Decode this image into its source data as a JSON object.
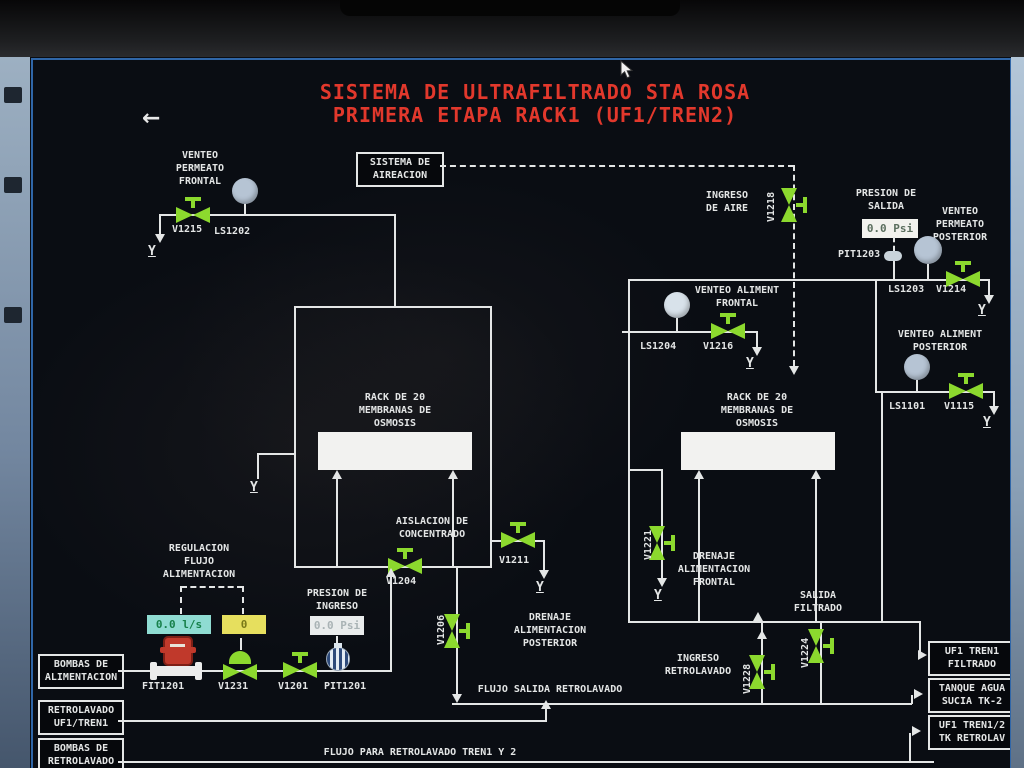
{
  "colors": {
    "bg": "#0a0d13",
    "line": "#e4e6e6",
    "valve": "#8cd92e",
    "title": "#e2382c",
    "cyan_box": "#8fdcd2",
    "yellow_box": "#e6df5e",
    "circle": "#b6c4d4",
    "circle_light": "#d8e2ea",
    "red_instrument": "#c0392b",
    "blue_instrument": "#2e4a7a"
  },
  "icons": {
    "back": "←"
  },
  "title": {
    "line1": "SISTEMA DE ULTRAFILTRADO STA ROSA",
    "line2": "PRIMERA ETAPA RACK1 (UF1/TREN2)"
  },
  "labels": {
    "venteo_permeato_frontal": "VENTEO\nPERMEATO\nFRONTAL",
    "sistema_aireacion": "SISTEMA DE\nAIREACION",
    "ingreso_de_aire": "INGRESO\nDE AIRE",
    "presion_de_salida": "PRESION DE\nSALIDA",
    "venteo_permeato_posterior": "VENTEO\nPERMEATO\nPOSTERIOR",
    "venteo_aliment_frontal": "VENTEO ALIMENT\nFRONTAL",
    "venteo_aliment_posterior": "VENTEO ALIMENT\nPOSTERIOR",
    "rack_membranas": "RACK DE 20\nMEMBRANAS DE\nOSMOSIS",
    "aislacion_concentrado": "AISLACION DE\nCONCENTRADO",
    "drenaje_alimentacion_frontal": "DRENAJE\nALIMENTACION\nFRONTAL",
    "drenaje_alimentacion_posterior": "DRENAJE\nALIMENTACION\nPOSTERIOR",
    "salida_filtrado": "SALIDA\nFILTRADO",
    "regulacion_flujo": "REGULACION\nFLUJO\nALIMENTACION",
    "presion_de_ingreso": "PRESION DE\nINGRESO",
    "ingreso_retrolavado": "INGRESO\nRETROLAVADO",
    "flujo_salida_retrolavado": "FLUJO SALIDA RETROLAVADO",
    "flujo_para_retrolavado": "FLUJO PARA RETROLAVADO TREN1 Y 2",
    "bombas_alimentacion": "BOMBAS DE\nALIMENTACION",
    "retrolavado_uf1_tren1": "RETROLAVADO\nUF1/TREN1",
    "bombas_retrolavado": "BOMBAS DE\nRETROLAVADO",
    "uf1_tren1_filtrado": "UF1 TREN1\nFILTRADO",
    "tanque_agua_sucia": "TANQUE AGUA\nSUCIA TK-2",
    "uf1_tren12_retrolav": "UF1 TREN1/2\nTK RETROLAV"
  },
  "tags": {
    "v1215": "V1215",
    "ls1202": "LS1202",
    "v1218": "V1218",
    "pit1203": "PIT1203",
    "ls1203": "LS1203",
    "v1214": "V1214",
    "ls1204": "LS1204",
    "v1216": "V1216",
    "ls1101": "LS1101",
    "v1115": "V1115",
    "v1204": "V1204",
    "v1211": "V1211",
    "v1221": "V1221",
    "v1206": "V1206",
    "v1228": "V1228",
    "v1224": "V1224",
    "fit1201": "FIT1201",
    "v1231": "V1231",
    "v1201": "V1201",
    "pit1201": "PIT1201"
  },
  "values": {
    "presion_salida": "0.0 Psi",
    "flujo_alimentacion": "0.0 l/s",
    "apertura_valvula": "0",
    "presion_ingreso": "0.0 Psi"
  }
}
